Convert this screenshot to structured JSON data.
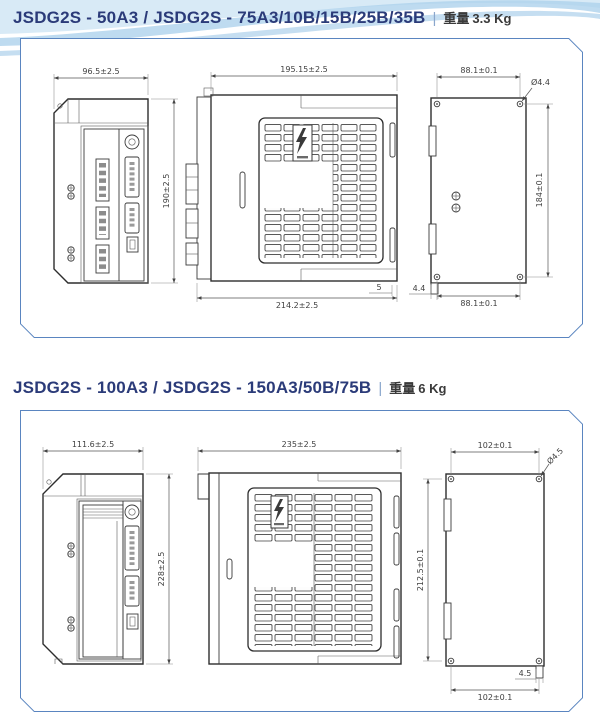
{
  "colors": {
    "title": "#2b3b79",
    "panel_border": "#5a85c0",
    "drawing_line": "#2d2d2d",
    "dimension_text": "#3f3f3f",
    "swoosh_light": "#d8eaf6",
    "swoosh_mid": "#aed2ec",
    "swoosh_dark": "#7fb6e0"
  },
  "sections": [
    {
      "title": "JSDG2S - 50A3 / JSDG2S - 75A3/10B/15B/25B/35B",
      "separator": "|",
      "weight_label": "重量",
      "weight_value": "3.3 Kg",
      "dims": {
        "front_width": "96.5±2.5",
        "front_height": "190±2.5",
        "side_depth": "195.15±2.5",
        "side_total": "214.2±2.5",
        "side_offset": "5",
        "rear_hook": "4.4",
        "rear_top_width": "88.1±0.1",
        "rear_hole": "Ø4.4",
        "rear_height": "184±0.1",
        "rear_bottom_width": "88.1±0.1"
      }
    },
    {
      "title": "JSDG2S - 100A3 / JSDG2S - 150A3/50B/75B",
      "separator": "|",
      "weight_label": "重量",
      "weight_value": "6 Kg",
      "dims": {
        "front_width": "111.6±2.5",
        "front_height": "228±2.5",
        "side_depth": "235±2.5",
        "rear_top_width": "102±0.1",
        "rear_hole": "Ø4.5",
        "rear_height": "212.5±0.1",
        "rear_bottom_width": "102±0.1",
        "rear_hook": "4.5"
      }
    }
  ]
}
